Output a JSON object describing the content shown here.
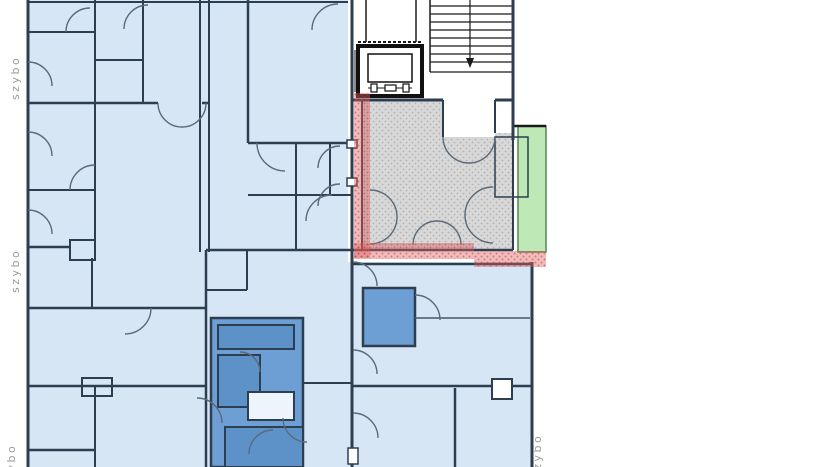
{
  "canvas": {
    "width": 835,
    "height": 467
  },
  "labels": {
    "shaft_top_left": "szybo",
    "shaft_mid_left": "szybo",
    "shaft_bottom_left": "szybo",
    "shaft_bottom_right": "szybo"
  },
  "colors": {
    "room_blue": "#d7e6f5",
    "dark_room": "#6d9fd4",
    "darker_room": "#5d92c9",
    "pale_room": "#edf4fb",
    "wall": "#2c3e50",
    "door": "#5a6a78",
    "hatch_base": "#d8d8d8",
    "hatch_dot": "#b3b3b3",
    "red": "#dd5c5c",
    "red_dark": "#b63a3a",
    "green": "#bfe8b7",
    "green_border": "#548554",
    "stair": "#1a1a1a",
    "label": "#9a9a9a"
  }
}
